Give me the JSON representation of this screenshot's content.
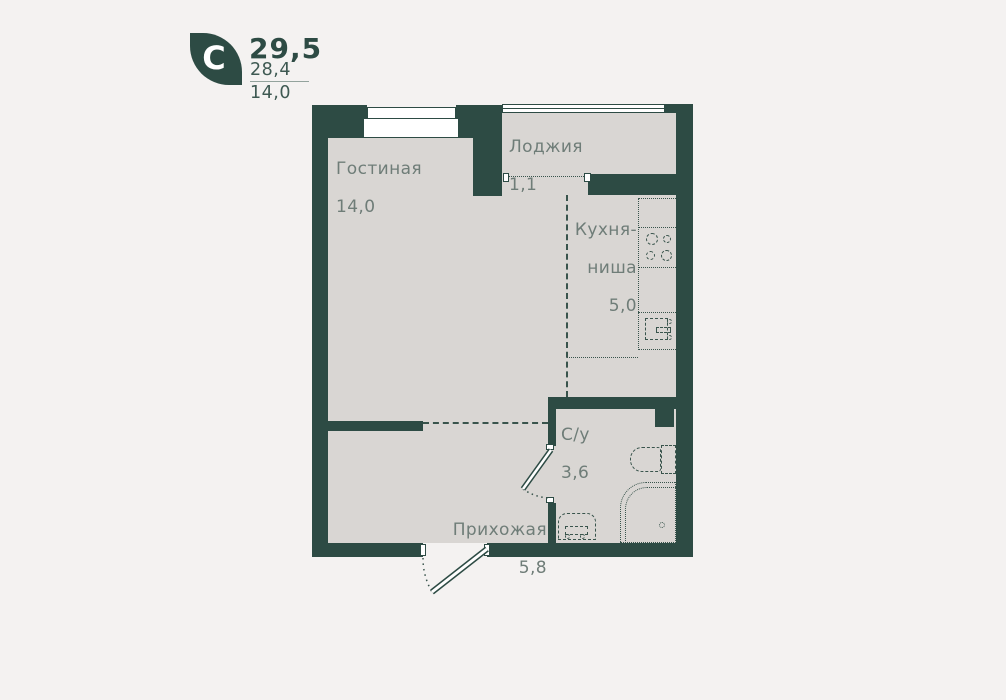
{
  "colors": {
    "bg": "#f4f2f1",
    "wall": "#2d4b44",
    "floor": "#d9d6d3",
    "label": "#6f7d78",
    "line": "#39544c",
    "accent": "#3e5952",
    "divider": "#93a39d"
  },
  "logo": {
    "letter": "C",
    "area_total": "29,5",
    "area_secondary": "28,4",
    "area_tertiary": "14,0"
  },
  "rooms": {
    "living": {
      "name": "Гостиная",
      "area": "14,0"
    },
    "loggia": {
      "name": "Лоджия",
      "area": "1,1"
    },
    "kitchen": {
      "name_line1": "Кухня-",
      "name_line2": "ниша",
      "area": "5,0"
    },
    "bathroom": {
      "name": "С/у",
      "area": "3,6"
    },
    "hallway": {
      "name": "Прихожая",
      "area": "5,8"
    }
  }
}
